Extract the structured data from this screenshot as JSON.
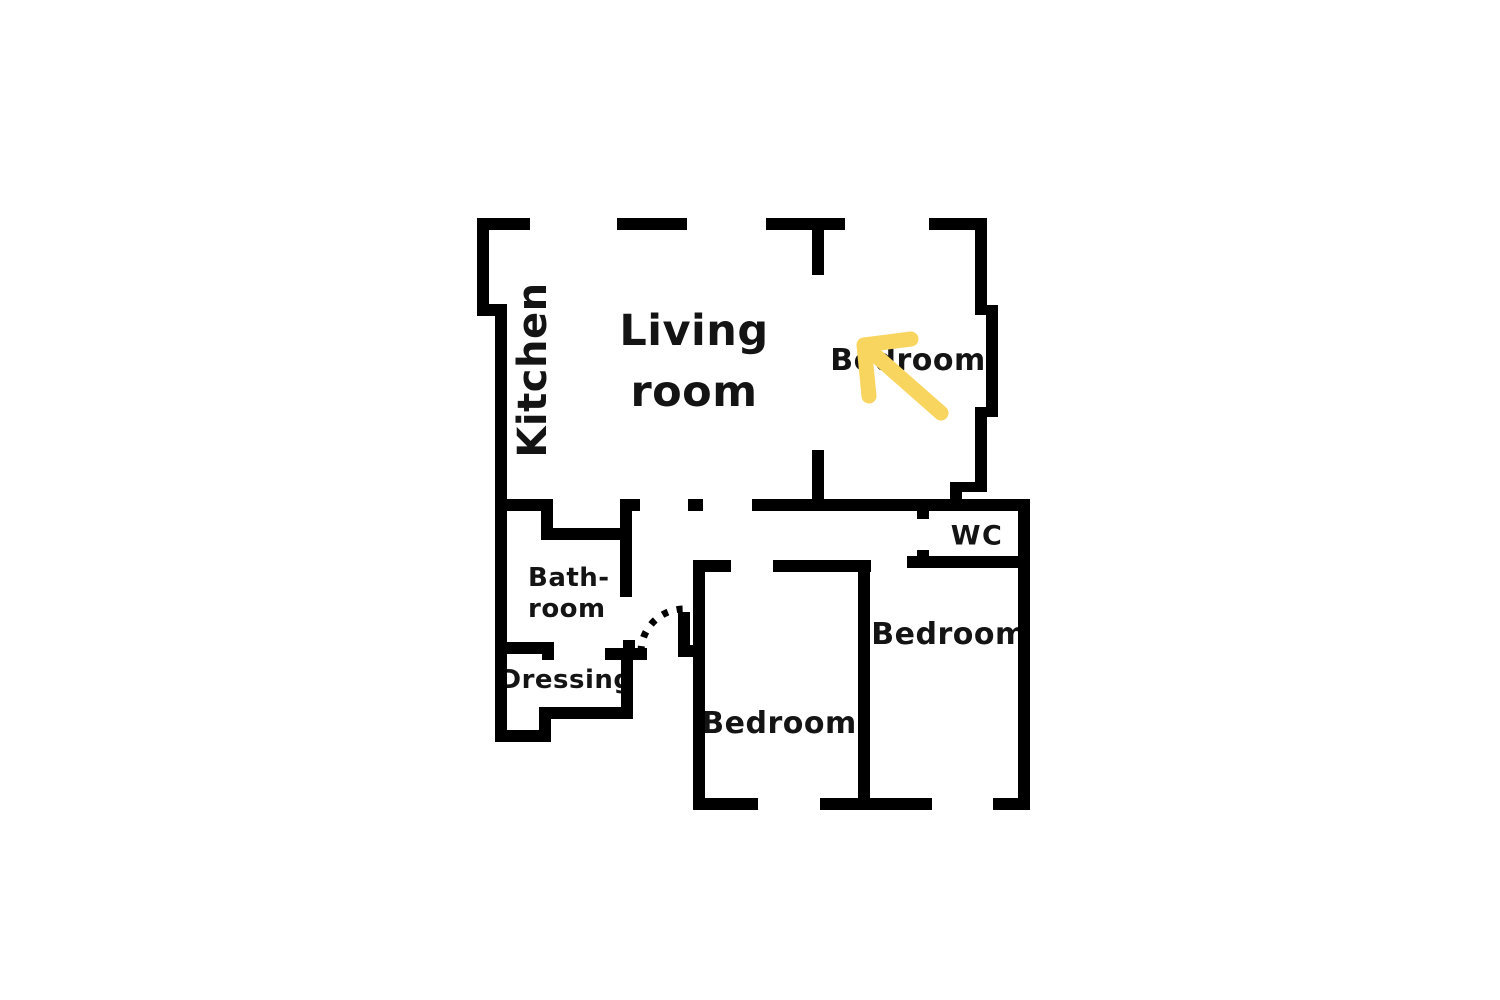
{
  "colors": {
    "background": "#ffffff",
    "wall": "#000000",
    "text": "#141414",
    "arrow": "#F8D55E"
  },
  "floorplan": {
    "rooms": {
      "kitchen": {
        "label": "Kitchen"
      },
      "living_room": {
        "label": "Living\nroom"
      },
      "bedroom_top_right": {
        "label": "Bedroom"
      },
      "wc": {
        "label": "WC"
      },
      "bedroom_right": {
        "label": "Bedroom"
      },
      "bedroom_bottom": {
        "label": "Bedroom"
      },
      "bathroom": {
        "label": "Bath-\nroom"
      },
      "dressing": {
        "label": "Dressing"
      }
    }
  }
}
